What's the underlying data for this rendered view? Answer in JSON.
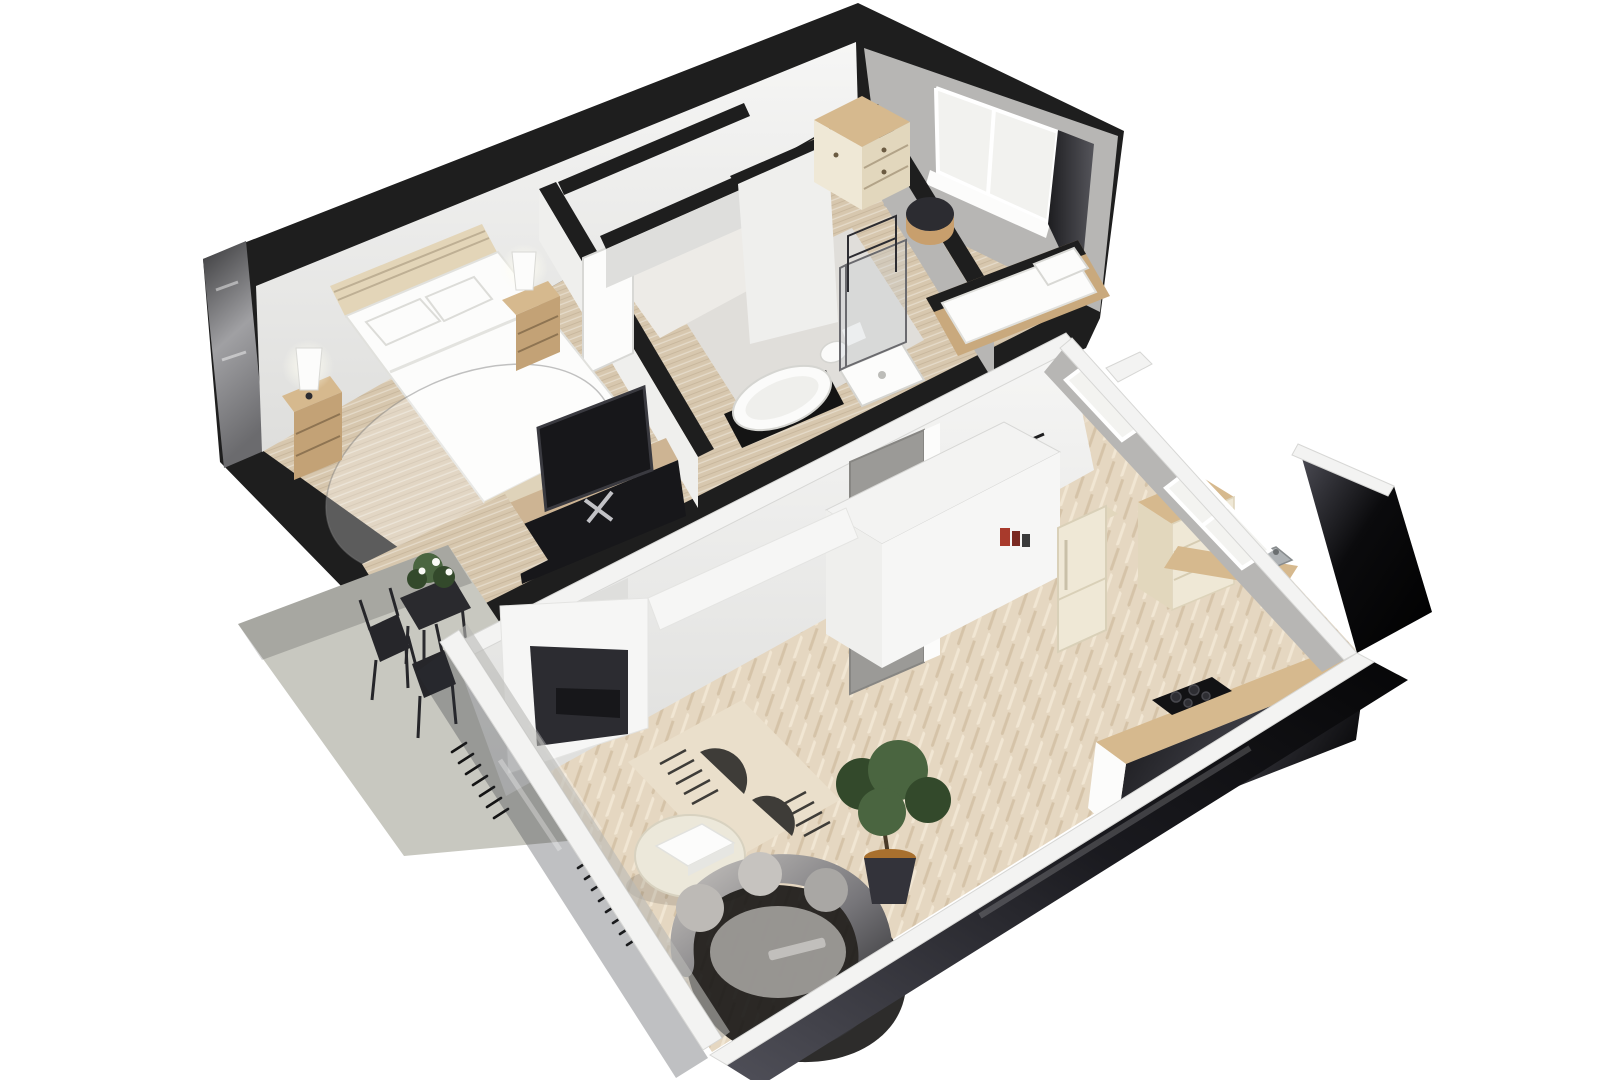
{
  "meta": {
    "kind": "3d-floor-plan-render",
    "description": "Isometric cutaway 3D floor plan of two stacked apartment units with terrace",
    "visible_text": []
  },
  "palette": {
    "pageBg": "#ffffff",
    "inkBlack": "#141414",
    "capBlack": "#1e1e1e",
    "glossA": "#39393b",
    "glossB": "#a0a0a3",
    "glossC": "#6b6b6e",
    "wallWhite": "#f6f6f5",
    "wallFace": "#efefed",
    "wallShade": "#dededc",
    "wallGray": "#b7b6b4",
    "wallGrayDark": "#928f8c",
    "floorWood": "#d7c7ae",
    "floorWoodDark": "#c9b79c",
    "floorBath": "#e0deda",
    "floorHall": "#edebe7",
    "floorHerr": "#e5d7c1",
    "herrDark": "#d5c3a8",
    "herrLight": "#f1e6d3",
    "capWhite": "#f3f3f2",
    "capEdge": "#d7d7d5",
    "glassR1": "#0b0b0d",
    "glassR2": "#51515a",
    "glassTint": "rgba(44,46,52,0.30)",
    "beige": "#e3d5b8",
    "beigeShade": "#d3c2a0",
    "woodFurn": "#d6b98e",
    "woodFurnDark": "#c3a276",
    "cream": "#efe8d6",
    "creamShade": "#e2d7bd",
    "tvBlack": "#17171a",
    "nicheDark": "#2c2c31",
    "sofaA": "#cbc8c4",
    "sofaB": "#232325",
    "shadowDark": "#161514",
    "rugBase": "#eadfcb",
    "rugInk": "#3e3c38",
    "green1": "#4a6540",
    "green2": "#33492b",
    "potDark": "#33333a",
    "potSoil": "#a8702e",
    "concrete": "#c8c8c0",
    "concreteShade": "#b0b0a7",
    "steel": "#aeb2b5",
    "accentRed": "#a83a2c",
    "doorGray": "#9b9a97",
    "glow": "#fffef2"
  },
  "scene": {
    "upper_apartment": {
      "label": "upper apartment",
      "rooms": [
        "master bedroom",
        "hallway with closets",
        "bathroom",
        "small bedroom"
      ],
      "furniture": [
        "double bed",
        "upholstered headboard",
        "two nightstands with lamps",
        "tv sideboard with tv",
        "round sheer rug",
        "wardrobe chest",
        "single bed",
        "round bedside pouf",
        "bathtub with black vanity",
        "wall hung toilet",
        "glass shower",
        "towel stand",
        "corner window with curtain"
      ]
    },
    "lower_apartment": {
      "label": "lower apartment",
      "rooms": [
        "entry hall",
        "living room",
        "kitchen",
        "window bays"
      ],
      "furniture": [
        "entry door",
        "coat rack",
        "storage core with shelves",
        "retro fridge",
        "kitchen drawer cabinet",
        "corner counter with sink",
        "long counter with cooktop",
        "recessed wall tv niche",
        "patterned area rug",
        "round coffee table with tray",
        "curved sofa",
        "potted tree",
        "floor radiators",
        "herringbone parquet",
        "glass facade walls"
      ]
    },
    "terrace": {
      "label": "terrace",
      "furniture": [
        "concrete patio slab",
        "bistro table with plant",
        "two bistro chairs"
      ]
    }
  }
}
